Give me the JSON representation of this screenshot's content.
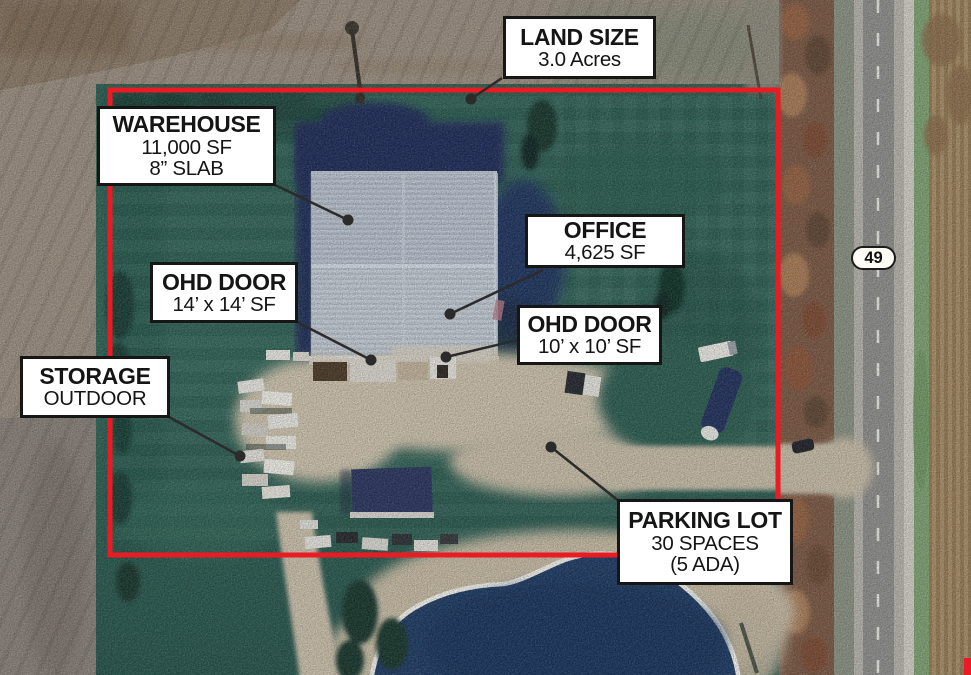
{
  "colors": {
    "boundary_red": "#ea1b22",
    "leader_line": "#2b2b2b",
    "leader_dot": "#2b2b2b",
    "label_bg": "#ffffff",
    "label_border": "#161616",
    "label_text": "#151515"
  },
  "labels": {
    "land_size": {
      "title": "LAND SIZE",
      "line1": "3.0 Acres"
    },
    "warehouse": {
      "title": "WAREHOUSE",
      "line1": "11,000 SF",
      "line2": "8” SLAB"
    },
    "office": {
      "title": "OFFICE",
      "line1": "4,625 SF"
    },
    "ohd_door_west": {
      "title": "OHD DOOR",
      "line1": "14’ x 14’ SF"
    },
    "ohd_door_east": {
      "title": "OHD DOOR",
      "line1": "10’ x 10’ SF"
    },
    "storage": {
      "title": "STORAGE",
      "line1": "OUTDOOR"
    },
    "parking": {
      "title": "PARKING LOT",
      "line1": "30 SPACES",
      "line2": "(5 ADA)"
    }
  },
  "route_shield": {
    "number": "49"
  }
}
